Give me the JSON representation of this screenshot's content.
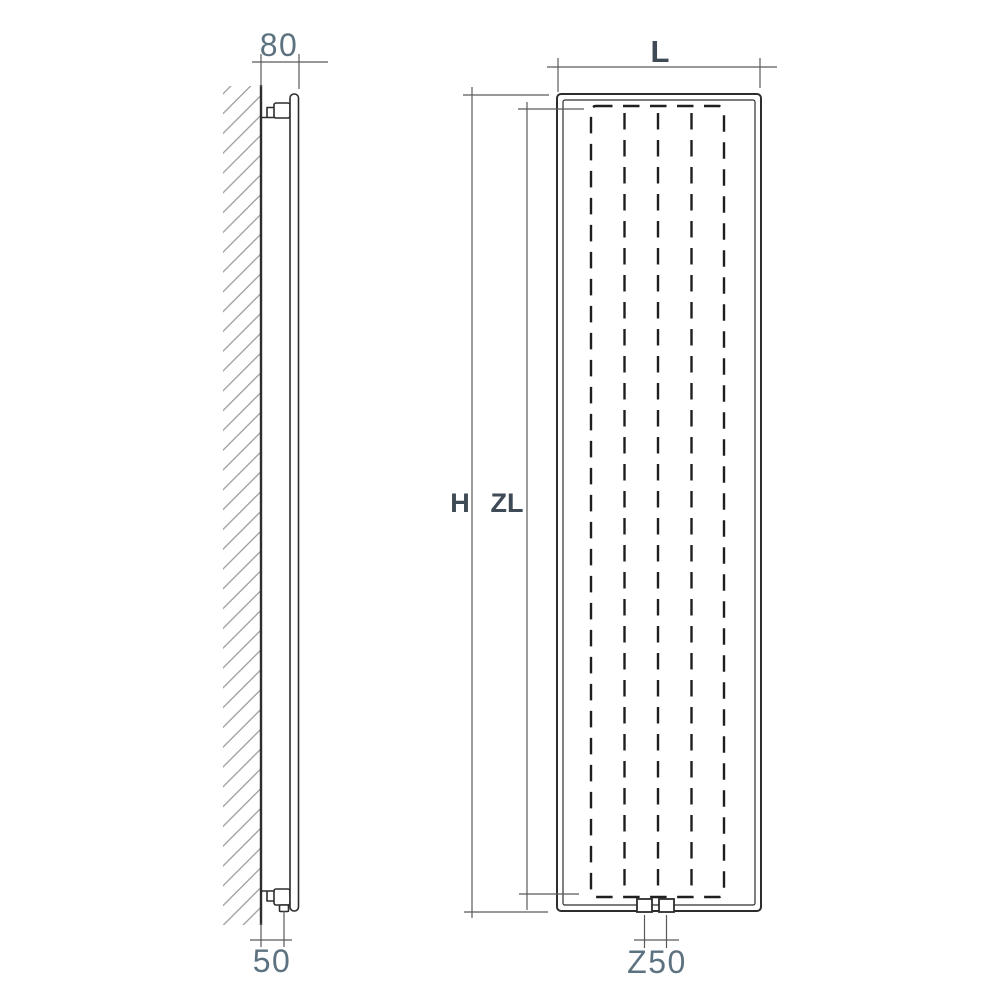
{
  "side_view": {
    "depth_dim": "80",
    "connection_offset_dim": "50"
  },
  "front_view": {
    "width_dim": "L",
    "height_dim": "H",
    "convector_length_dim": "ZL",
    "connection_spacing_dim": "Z50"
  },
  "colors": {
    "bg": "#ffffff",
    "line_object": "#2d2d2d",
    "line_dimension": "#5a5a5a",
    "line_hatch": "#9a9a9a",
    "line_dashed": "#1f1f1f",
    "label_numeric": "#5d7280",
    "label_letter": "#3e4a55"
  }
}
